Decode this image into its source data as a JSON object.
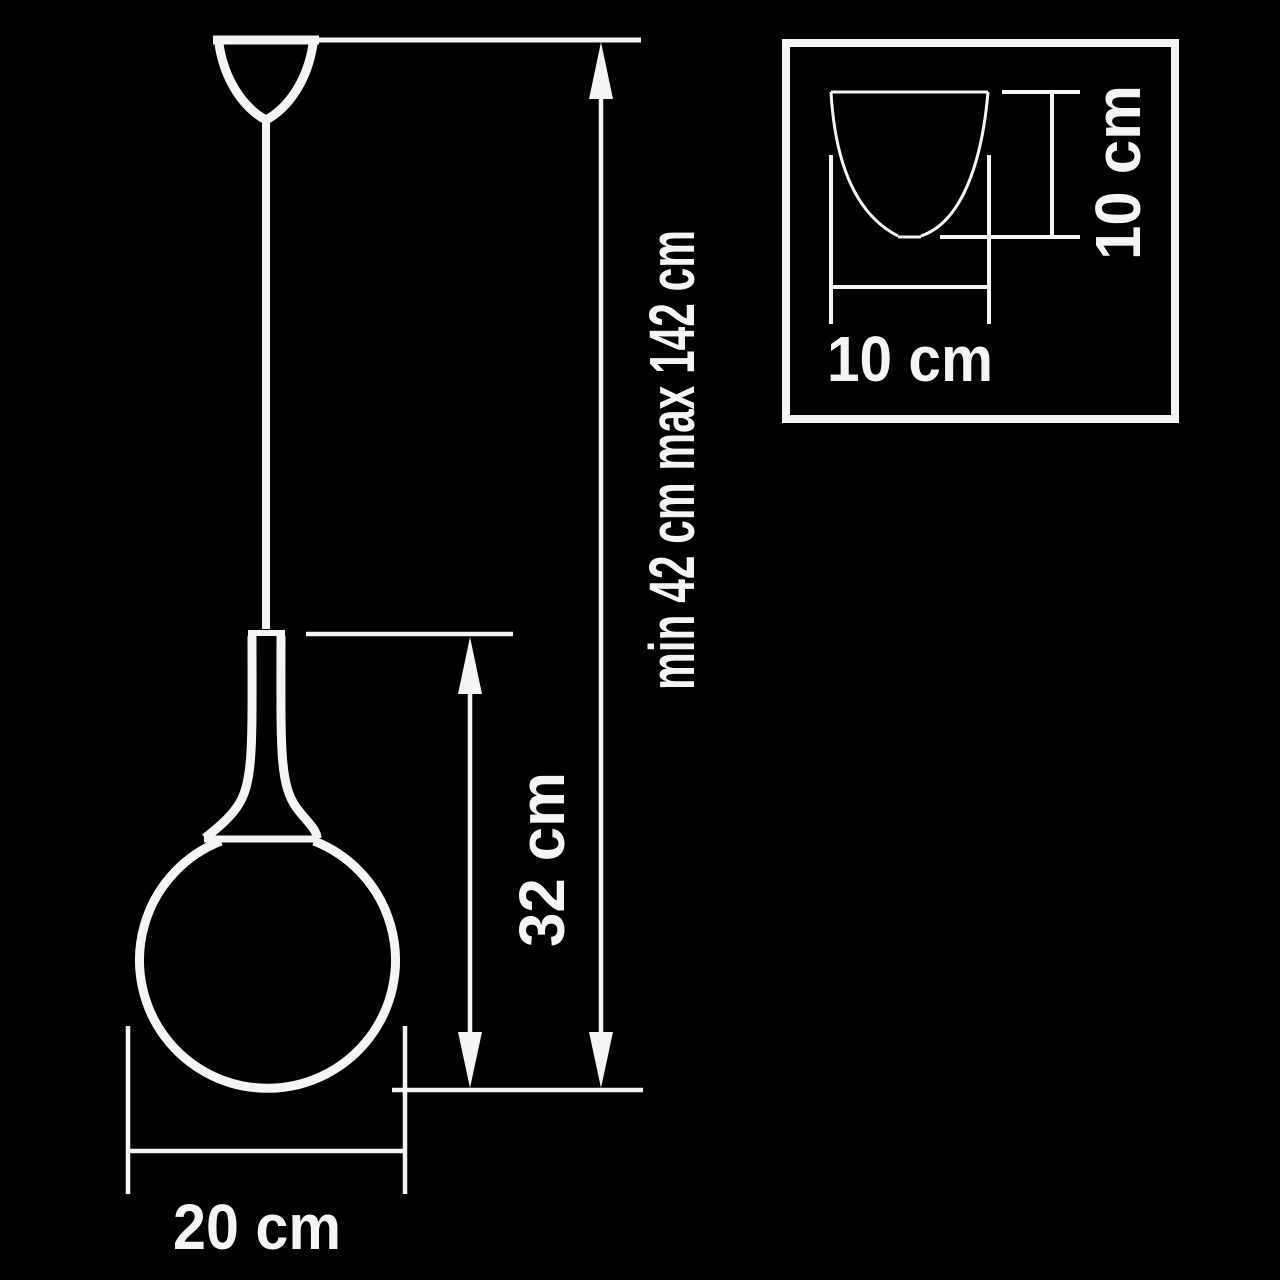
{
  "diagram": {
    "type": "pendant-lamp-dimension-drawing",
    "colors": {
      "background": "#000000",
      "line": "#f5f5f5"
    },
    "main_view": {
      "overall_height_label": "min 42 cm max 142 cm",
      "body_height_label": "32 cm",
      "shade_diameter_label": "20 cm"
    },
    "inset_view": {
      "width_label": "10 cm",
      "height_label": "10 cm"
    }
  }
}
